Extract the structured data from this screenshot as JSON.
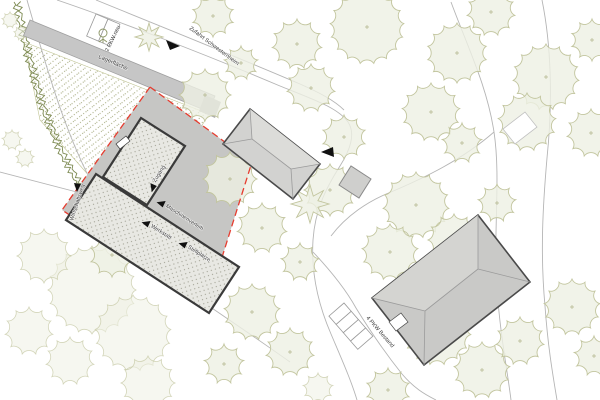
{
  "labels": {
    "storage_area": "Lagerfläche",
    "parking_new": "2 PKW neu",
    "access_road": "Zufahrt Schwesternheim",
    "entrance": "Zugang",
    "machine_rental": "Maschinenverleih",
    "workshop": "Werkstatt",
    "parking_spaces": "Stellplätze",
    "service_path": "Wirtschaftsweg",
    "parking_existing": "4 PKW Bestand"
  },
  "colors": {
    "boundary_red": "#e63c2f",
    "paving_gray": "#c6c6c4",
    "shadow_gray": "#a9a9a7",
    "building_hatch_bg": "#e8e8e3",
    "building_outline": "#3a3a3a",
    "roof_gray": "#d2d2d0",
    "tree_stroke": "#c2c59e",
    "tree_fill": "#eef0e3",
    "tree_mark": "#b2b58c",
    "hedge_green": "#7d8a52",
    "road_gray": "#b5b5b5"
  },
  "map": {
    "trees": [
      [
        213,
        16,
        21
      ],
      [
        297,
        44,
        25
      ],
      [
        367,
        27,
        37
      ],
      [
        457,
        53,
        30
      ],
      [
        491,
        12,
        24
      ],
      [
        546,
        77,
        33
      ],
      [
        592,
        40,
        21
      ],
      [
        431,
        112,
        29
      ],
      [
        527,
        122,
        29
      ],
      [
        591,
        133,
        24
      ],
      [
        462,
        143,
        20
      ],
      [
        344,
        137,
        22
      ],
      [
        311,
        88,
        24
      ],
      [
        205,
        95,
        26
      ],
      [
        241,
        63,
        17
      ],
      [
        230,
        179,
        27
      ],
      [
        262,
        228,
        25
      ],
      [
        330,
        190,
        26
      ],
      [
        300,
        262,
        19
      ],
      [
        112,
        255,
        22
      ],
      [
        416,
        205,
        33
      ],
      [
        454,
        240,
        26
      ],
      [
        390,
        252,
        28
      ],
      [
        497,
        203,
        19
      ],
      [
        437,
        331,
        34
      ],
      [
        482,
        370,
        28
      ],
      [
        520,
        341,
        24
      ],
      [
        572,
        307,
        28
      ],
      [
        594,
        356,
        20
      ],
      [
        388,
        390,
        22
      ],
      [
        252,
        312,
        28
      ],
      [
        290,
        352,
        24
      ],
      [
        224,
        364,
        20
      ]
    ],
    "faint_trees": [
      [
        92,
        290,
        44
      ],
      [
        133,
        333,
        38
      ],
      [
        44,
        256,
        27
      ],
      [
        29,
        331,
        24
      ],
      [
        148,
        383,
        27
      ],
      [
        70,
        361,
        24
      ],
      [
        12,
        140,
        10
      ],
      [
        25,
        158,
        9
      ],
      [
        10,
        20,
        8
      ],
      [
        21,
        33,
        7
      ],
      [
        318,
        388,
        15
      ]
    ],
    "star_shrubs": [
      [
        149,
        37,
        14
      ],
      [
        310,
        204,
        19
      ]
    ],
    "hedge": {
      "points": [
        [
          14,
          2
        ],
        [
          26,
          55
        ],
        [
          40,
          105
        ],
        [
          58,
          150
        ],
        [
          80,
          190
        ],
        [
          98,
          216
        ]
      ],
      "amplitude": 2.6,
      "offset": 4.5
    }
  }
}
